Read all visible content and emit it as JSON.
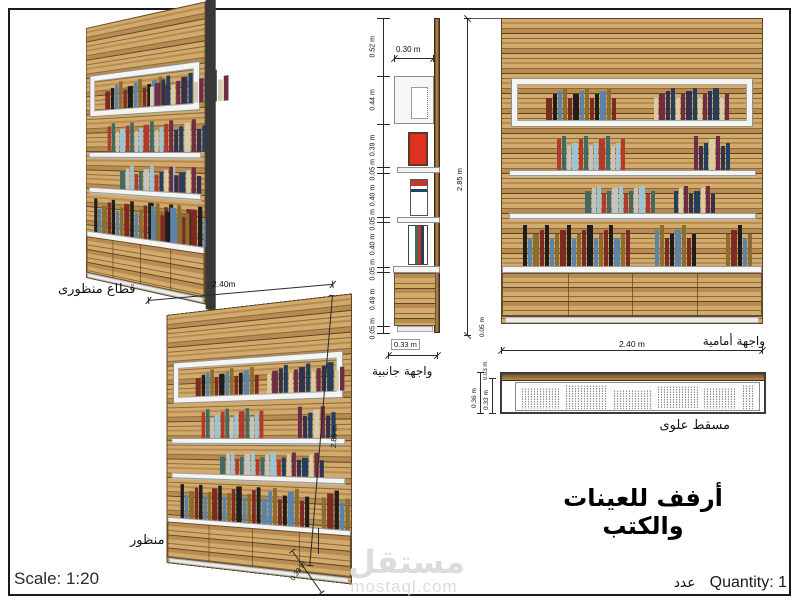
{
  "sheet": {
    "title": "أرفف للعينات والكتب",
    "scale_label": "Scale: 1:20",
    "quantity_label": "Quantity: 1",
    "quantity_ar": "عدد",
    "watermark_name": "مستقل",
    "watermark_domain": "mostaql.com"
  },
  "views": {
    "perspective_section": {
      "label": "قطاع منظورى"
    },
    "perspective": {
      "label": "منظور",
      "dim_width": "2.40m",
      "dim_height": "2.85 m",
      "dim_depth": "0.33 m"
    },
    "side": {
      "label": "واجهة جانبية",
      "dim_top_depth": "0.30 m",
      "dim_bottom_depth": "0.33 m",
      "segments": [
        {
          "label": "0.52 m",
          "m": 0.52
        },
        {
          "label": "0.44 m",
          "m": 0.44
        },
        {
          "label": "0.39 m",
          "m": 0.39
        },
        {
          "label": "0.05 m",
          "m": 0.05
        },
        {
          "label": "0.40 m",
          "m": 0.4
        },
        {
          "label": "0.05 m",
          "m": 0.05
        },
        {
          "label": "0.40 m",
          "m": 0.4
        },
        {
          "label": "0.05 m",
          "m": 0.05
        },
        {
          "label": "0.49 m",
          "m": 0.49
        },
        {
          "label": "0.05 m",
          "m": 0.05
        }
      ]
    },
    "front": {
      "label": "واجهة أمامية",
      "dim_height": "2.85 m",
      "dim_width": "2.40 m",
      "dim_base": "0.05 m"
    },
    "plan": {
      "label": "مسقط علوى",
      "dim_outer": "0.36 m",
      "dim_inner": "0.33 m",
      "dim_back": "0.03 m"
    }
  },
  "bookcase": {
    "shelves": [
      {
        "type": "boxed",
        "groups": [
          {
            "left": 11,
            "count": 13,
            "seed": 0
          },
          {
            "left": 60,
            "count": 14,
            "seed": 4
          }
        ]
      },
      {
        "type": "board",
        "groups": [
          {
            "left": 21,
            "count": 13,
            "seed": 2
          },
          {
            "left": 74,
            "count": 7,
            "seed": 7
          }
        ]
      },
      {
        "type": "board",
        "groups": [
          {
            "left": 32,
            "count": 13,
            "seed": 5
          },
          {
            "left": 66,
            "count": 8,
            "seed": 1
          }
        ]
      },
      {
        "type": "board",
        "groups": [
          {
            "left": 8,
            "count": 20,
            "seed": 3
          },
          {
            "left": 59,
            "count": 8,
            "seed": 6
          },
          {
            "left": 86,
            "count": 5,
            "seed": 9
          }
        ]
      }
    ],
    "palette": [
      "#7d2a20",
      "#243f5c",
      "#b03a2e",
      "#1e1e1e",
      "#d9cba8",
      "#3f6b64",
      "#5b84a8",
      "#6f2d44",
      "#c3c3c1",
      "#8a6d2f",
      "#32324e",
      "#9cc4d4"
    ]
  },
  "colors": {
    "wood_light": "#d2ab6c",
    "wood_mid": "#b88b52",
    "wood_dark": "#8a6a3a",
    "wood_streak": "#5f4626",
    "wood_deep": "#6b4f2c",
    "shelf_white": "#f4f4f2",
    "shelf_edge": "#9a9a98",
    "panel_side": "#383838",
    "line": "#2a2a2a",
    "dim_text": "#111111",
    "watermark": "#dcdcdc",
    "book_red": "#e03020"
  }
}
